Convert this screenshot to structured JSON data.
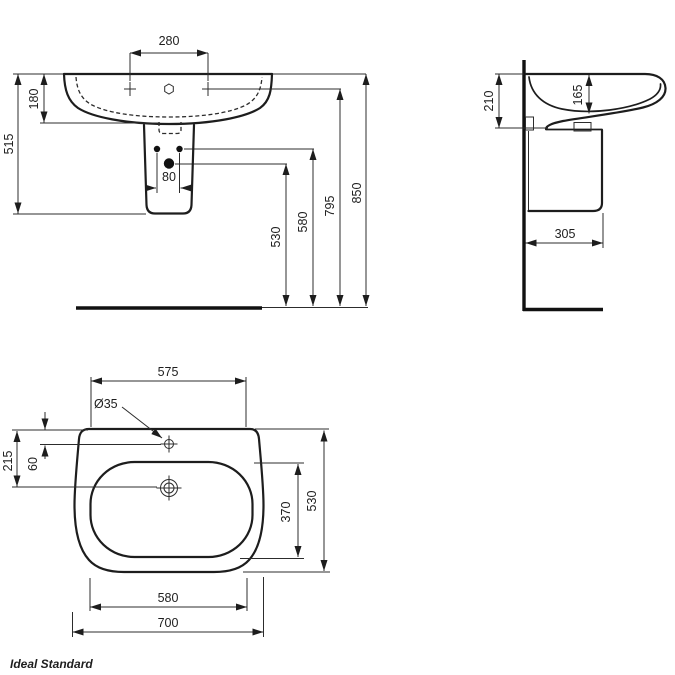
{
  "brand": {
    "name": "Ideal Standard",
    "color": "#1d4fa3"
  },
  "front": {
    "tap_spacing": "280",
    "bowl_depth": "180",
    "height_left": "515",
    "fixing_spacing": "80",
    "siphon_height": "530",
    "fixing_height": "580",
    "tap_height": "795",
    "overall_height": "850"
  },
  "side": {
    "front_depth": "210",
    "bowl_inner_depth": "165",
    "pedestal_depth": "305"
  },
  "plan": {
    "back_width": "575",
    "tap_hole_dia": "Ø35",
    "drain_offset": "215",
    "tap_offset": "60",
    "bowl_length": "370",
    "overall_depth": "530",
    "front_width": "580",
    "overall_width": "700"
  }
}
